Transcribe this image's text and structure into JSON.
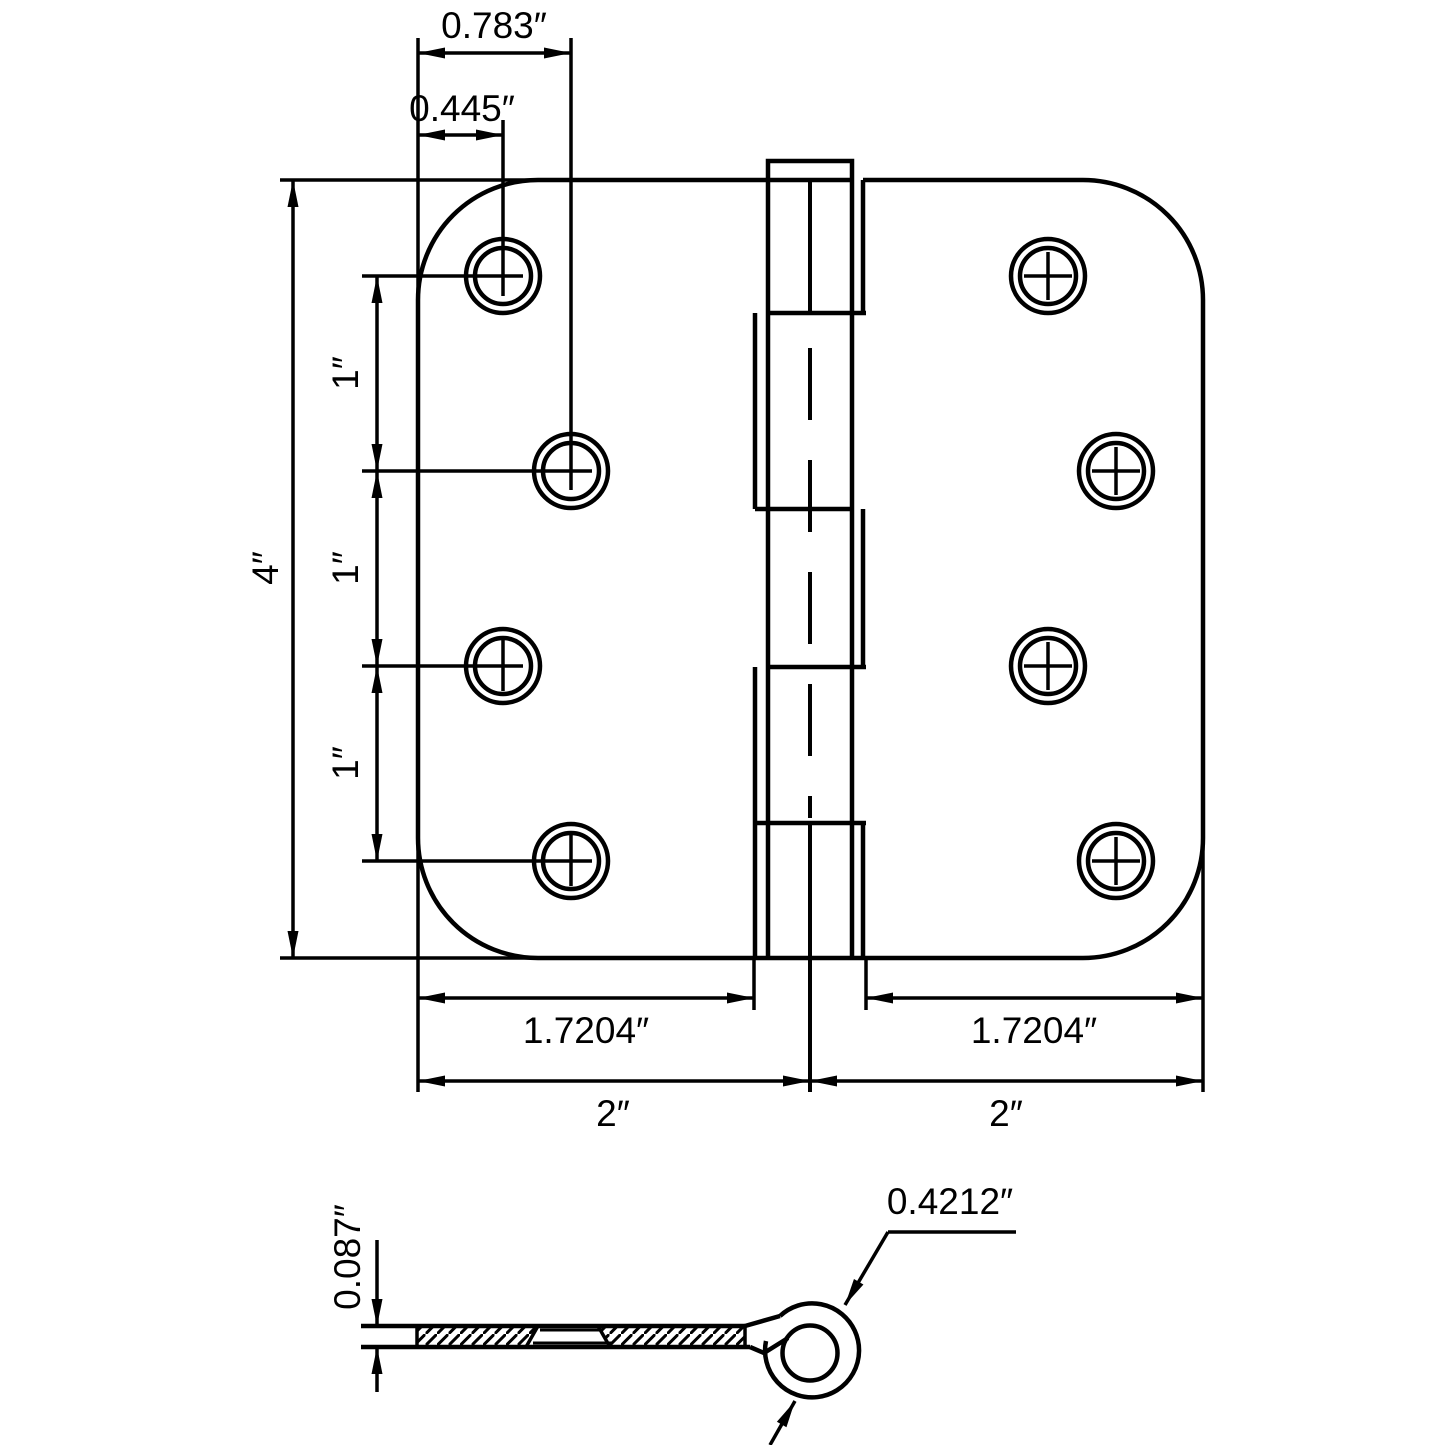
{
  "colors": {
    "ink": "#000000",
    "paper": "#ffffff"
  },
  "front_view": {
    "dim_top_outer": "0.783″",
    "dim_top_inner": "0.445″",
    "dim_height": "4″",
    "dim_spacing_1": "1″",
    "dim_spacing_2": "1″",
    "dim_spacing_3": "1″",
    "dim_leaf_left": "1.7204″",
    "dim_leaf_right": "1.7204″",
    "dim_half_left": "2″",
    "dim_half_right": "2″"
  },
  "side_view": {
    "dim_thickness": "0.087″",
    "dim_knuckle_diameter": "0.4212″"
  }
}
